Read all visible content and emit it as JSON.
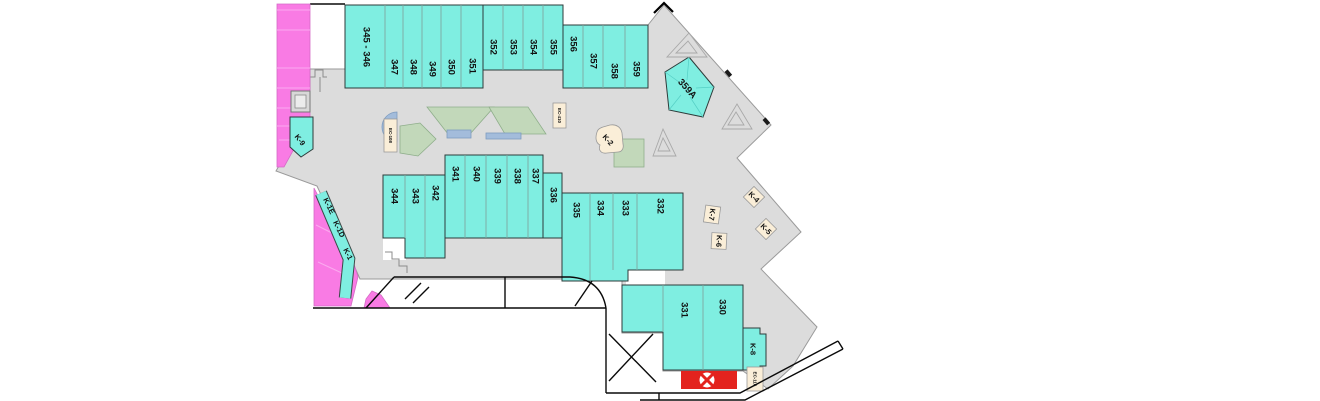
{
  "stores": {
    "s345_346": "345 - 346",
    "s347": "347",
    "s348": "348",
    "s349": "349",
    "s350": "350",
    "s351": "351",
    "s352": "352",
    "s353": "353",
    "s354": "354",
    "s355": "355",
    "s356": "356",
    "s357": "357",
    "s358": "358",
    "s359": "359",
    "s359a": "359A",
    "s344": "344",
    "s343": "343",
    "s342": "342",
    "s341": "341",
    "s340": "340",
    "s339": "339",
    "s338": "338",
    "s337": "337",
    "s336": "336",
    "s335": "335",
    "s334": "334",
    "s333": "333",
    "s332": "332",
    "s331": "331",
    "s330": "330"
  },
  "kiosks": {
    "k1": "K-1",
    "k1d": "K-1D",
    "k1e": "K-1E",
    "k2": "K-2",
    "k4": "K-4",
    "k5": "K-5",
    "k6": "K-6",
    "k7": "K-7",
    "k8": "K-8",
    "k9": "K-9"
  },
  "equipment_labels": {
    "ec410": "EC-410",
    "ec108": "EC-108",
    "ec116": "EC-116"
  },
  "icons": {
    "red_x_marker": "crossed-x-in-circle",
    "elevator": "double-square"
  },
  "colors": {
    "concourse": "#dcdcdc",
    "store": "#7feee1",
    "pink": "#f97be4",
    "kioskbg": "#faeed8",
    "red": "#e3231e",
    "water": "#a3bcdb",
    "planter": "#c2d8ba"
  }
}
